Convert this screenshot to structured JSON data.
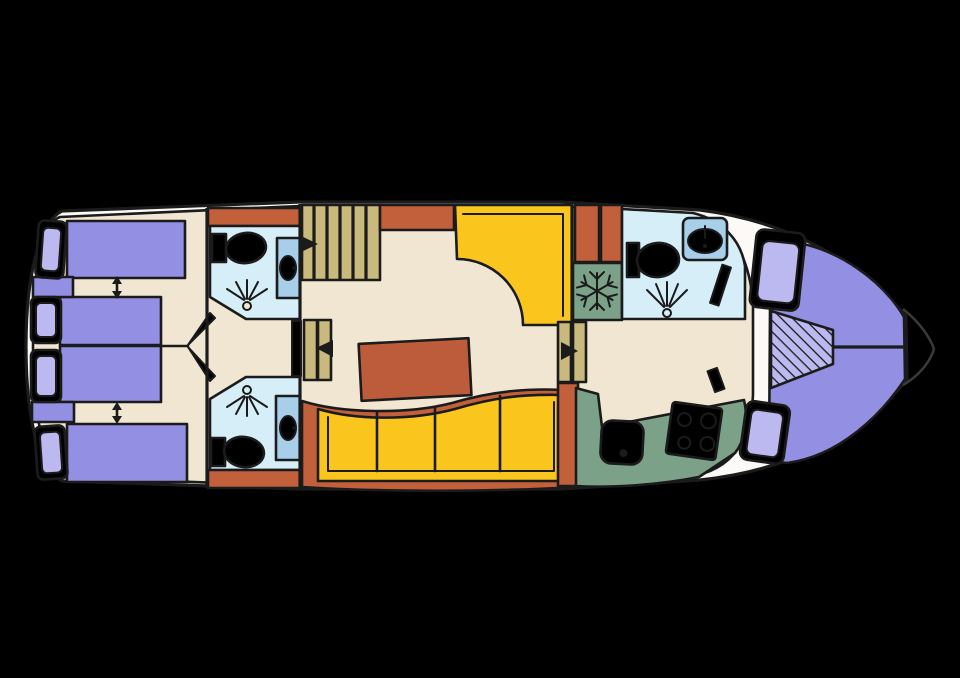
{
  "diagram": {
    "kind": "boat-floor-plan",
    "orientation": "bow-right",
    "visible_text": []
  },
  "colors": {
    "background": "#000000",
    "outline": "#1b1b1b",
    "hull": "#fbfaf6",
    "floor": "#f1e6d2",
    "accent_orange": "#c2603c",
    "table_brown": "#bd5c3a",
    "bed_purple": "#9390e3",
    "cushion_purple": "#bcb9f1",
    "seat_yellow": "#fac61e",
    "step_tan": "#c9b97c",
    "bath_blue": "#d6eef8",
    "sink_blue": "#a7cfe9",
    "galley_green": "#7ca189",
    "bow_tip_line": "#3a3a3a"
  },
  "areas": {
    "aft_cabins": {
      "beds": 4,
      "pillows": 4,
      "convertible_bed_arrows": 2,
      "cabin_doors": 2
    },
    "bathroom_top_left": {
      "fixtures": [
        "toilet",
        "washbasin",
        "shower-spray"
      ]
    },
    "bathroom_bottom_left": {
      "fixtures": [
        "toilet",
        "washbasin",
        "shower-spray"
      ]
    },
    "entry_stairs": {
      "steps": 6,
      "arrow_direction": "right"
    },
    "saloon": {
      "corner_seat": 1,
      "table": 1,
      "curved_bench_seats": 4,
      "steps_down_aft": {
        "arrow_direction": "left"
      },
      "steps_down_fwd": {
        "arrow_direction": "right"
      }
    },
    "fridge": {
      "icon": "snowflake-icon"
    },
    "bathroom_right": {
      "fixtures": [
        "toilet",
        "washbasin",
        "shower-spray"
      ],
      "door": 1
    },
    "galley": {
      "fixtures": [
        "sink",
        "stove-4-burner"
      ]
    },
    "bow": {
      "v_berth": true,
      "cushions": 2,
      "hatched_insert": true,
      "center_split_line": true
    }
  }
}
